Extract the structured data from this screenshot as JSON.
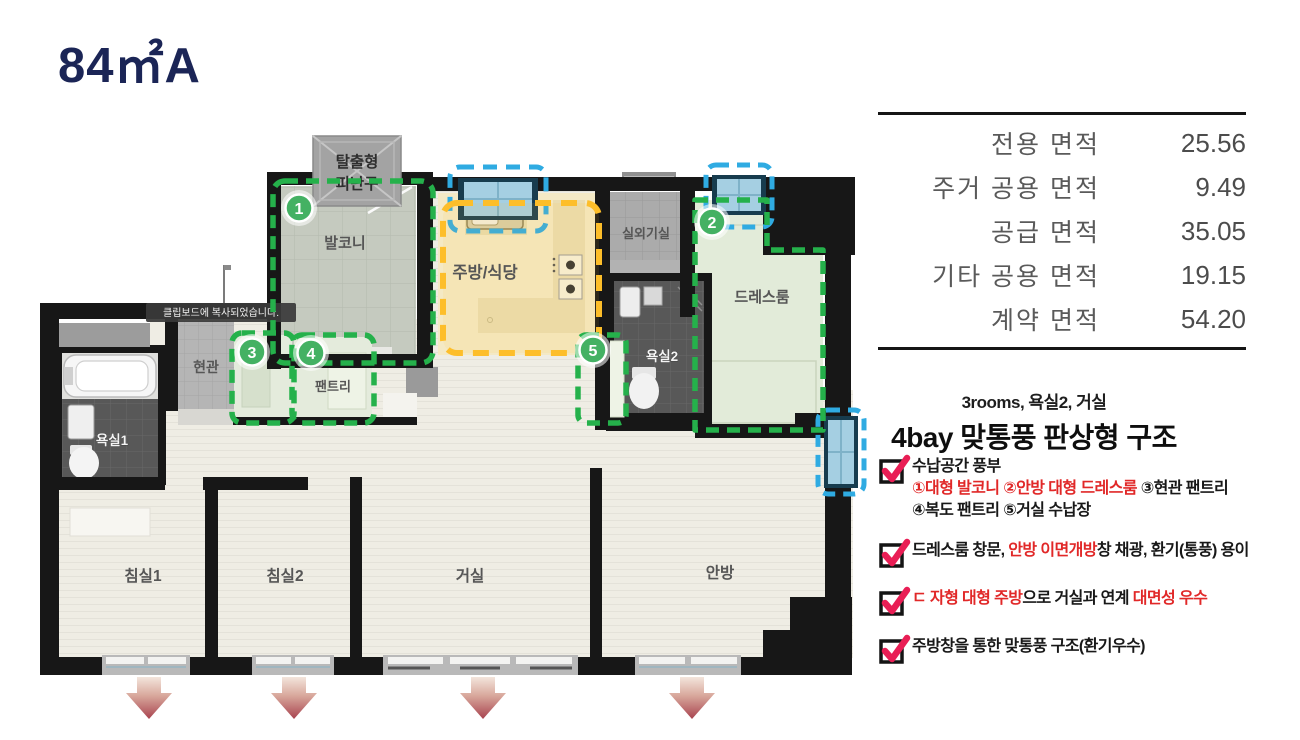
{
  "title": "84㎡A",
  "area_table": {
    "rows": [
      {
        "label": "전용 면적",
        "value": "25.56"
      },
      {
        "label": "주거 공용 면적",
        "value": "9.49"
      },
      {
        "label": "공급 면적",
        "value": "35.05"
      },
      {
        "label": "기타 공용 면적",
        "value": "19.15"
      },
      {
        "label": "계약 면적",
        "value": "54.20"
      }
    ]
  },
  "summary": {
    "line1": "3rooms, 욕실2, 거실",
    "line2": "4bay 맞통풍 판상형 구조"
  },
  "features": [
    {
      "lines": [
        [
          {
            "text": "수납공간 풍부",
            "red": false
          }
        ],
        [
          {
            "text": "①대형 발코니 ②안방 대형 드레스룸",
            "red": true
          },
          {
            "text": " ③현관 팬트리",
            "red": false
          }
        ],
        [
          {
            "text": "④복도 팬트리 ⑤거실 수납장",
            "red": false
          }
        ]
      ]
    },
    {
      "lines": [
        [
          {
            "text": "드레스룸 창문, ",
            "red": false
          },
          {
            "text": "안방 이면개방",
            "red": true
          },
          {
            "text": "창 채광, 환기(통풍) 용이",
            "red": false
          }
        ]
      ]
    },
    {
      "lines": [
        [
          {
            "text": "ㄷ 자형 대형 주방",
            "red": true
          },
          {
            "text": "으로 거실과 연계 ",
            "red": false
          },
          {
            "text": "대면성 우수",
            "red": true
          }
        ]
      ]
    },
    {
      "lines": [
        [
          {
            "text": "주방창을 통한 맞통풍 구조(환기우수)",
            "red": false
          }
        ]
      ]
    }
  ],
  "floorplan": {
    "tooltip": "클립보드에 복사되었습니다.",
    "escape_hatch": [
      "탈출형",
      "피난구"
    ],
    "rooms": {
      "balcony": "발코니",
      "kitchen": "주방/식당",
      "ac_room": "실외기실",
      "dress_room": "드레스룸",
      "bath2": "욕실2",
      "entrance": "현관",
      "pantry": "팬트리",
      "bath1": "욕실1",
      "bedroom1": "침실1",
      "bedroom2": "침실2",
      "living": "거실",
      "master": "안방"
    },
    "badges": [
      "1",
      "2",
      "3",
      "4",
      "5"
    ]
  },
  "colors": {
    "accent_green": "#25b14b",
    "accent_yellow": "#fdbe2a",
    "accent_cyan": "#2fabe2",
    "check_pink": "#e91e55",
    "text_red": "#e12828",
    "title_navy": "#1b2556",
    "wall_black": "#171717"
  }
}
